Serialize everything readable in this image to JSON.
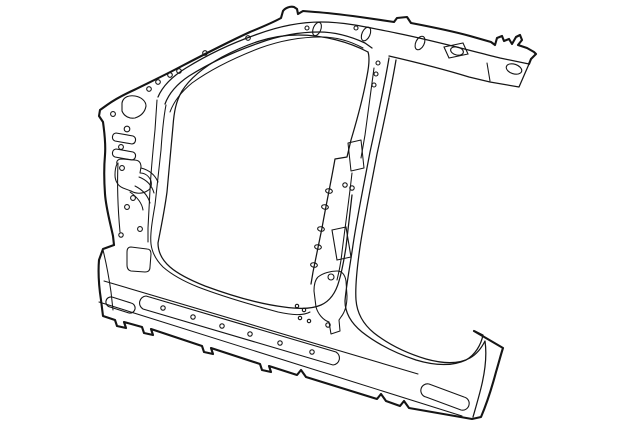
{
  "canvas": {
    "width": 640,
    "height": 440,
    "background": "#ffffff",
    "line_color": "#151515"
  },
  "diagram": {
    "type": "technical-line-art",
    "subject": "Vehicle body side aperture panel (uniside) with A-pillar, B-pillar, roof side rail and rocker panel",
    "aria_label": "Line drawing of a vehicle body side aperture panel showing A-pillar, roof side rail, B-pillar, rocker panel and lower quarter section",
    "text_labels": []
  }
}
